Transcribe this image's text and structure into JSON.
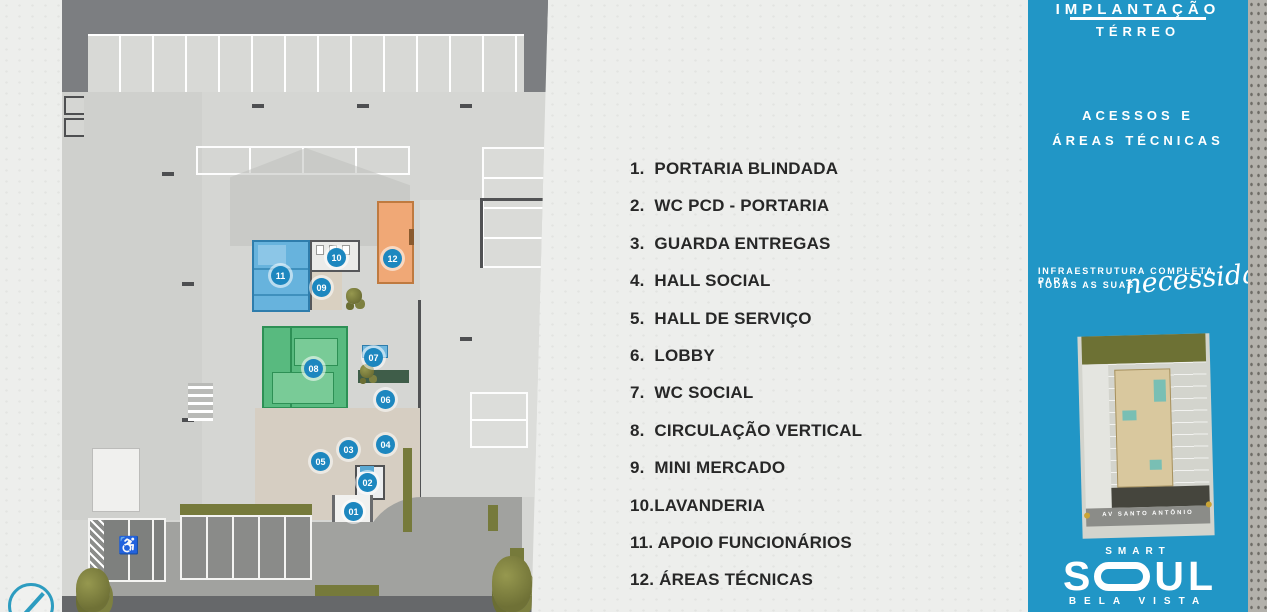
{
  "legend": {
    "items": [
      "1.  PORTARIA BLINDADA",
      "2.  WC PCD - PORTARIA",
      "3.  GUARDA ENTREGAS",
      "4.  HALL SOCIAL",
      "5.  HALL DE SERVIÇO",
      "6.  LOBBY",
      "7.  WC SOCIAL",
      "8.  CIRCULAÇÃO VERTICAL",
      "9.  MINI MERCADO",
      "10.LAVANDERIA",
      "11. APOIO FUNCIONÁRIOS",
      "12. ÁREAS TÉCNICAS"
    ]
  },
  "plan": {
    "markers": [
      "01",
      "02",
      "03",
      "04",
      "05",
      "06",
      "07",
      "08",
      "09",
      "10",
      "11",
      "12"
    ],
    "wheelchair_icon": "♿",
    "colors": {
      "room_blue": "#67b3dd",
      "room_green": "#58ba7f",
      "room_orange": "#f0a876",
      "marker_blue": "#1d87bf"
    }
  },
  "sidebar": {
    "accent_color": "#2196c6",
    "title_line1": "IMPLANTAÇÃO",
    "title_line2": "TÉRREO",
    "section_line1": "ACESSOS E",
    "section_line2": "ÁREAS TÉCNICAS",
    "tagline_line1": "INFRAESTRUTURA COMPLETA PARA",
    "tagline_line2": "TODAS AS SUAS",
    "tagline_script": "necessidades",
    "minimap": {
      "street_label": "AV  SANTO ANTÔNIO"
    },
    "logo": {
      "smart": "SMART",
      "soul_s": "S",
      "soul_u": "U",
      "soul_l": "L",
      "bela_vista": "BELA VISTA"
    }
  }
}
